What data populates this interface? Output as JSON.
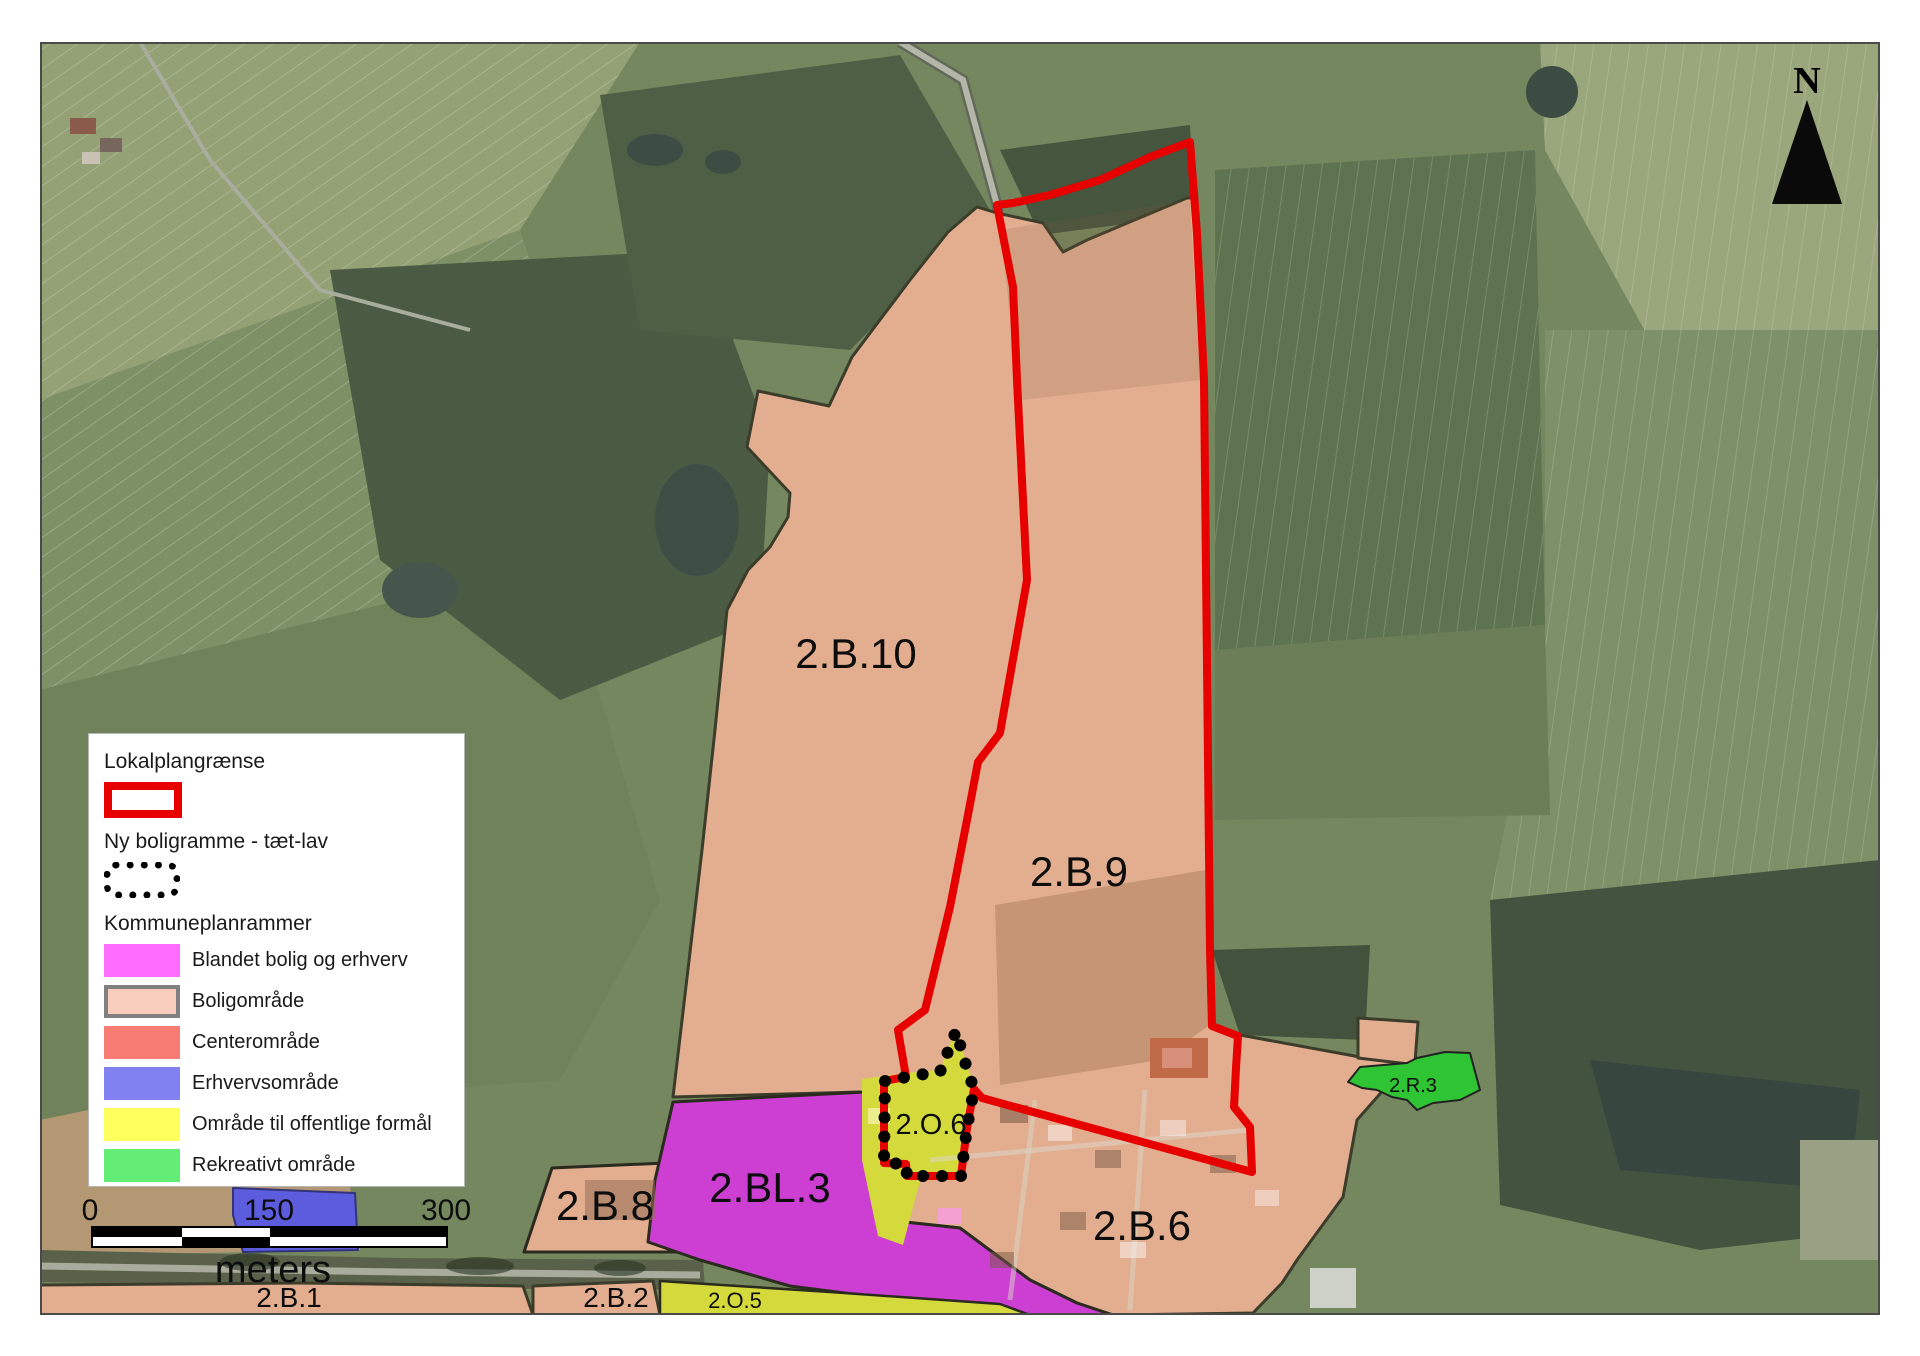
{
  "map": {
    "zone_labels": {
      "b10": "2.B.10",
      "b9": "2.B.9",
      "b6": "2.B.6",
      "b8": "2.B.8",
      "bl3": "2.BL.3",
      "b1": "2.B.1",
      "b2": "2.B.2",
      "o5": "2.O.5",
      "o6": "2.O.6",
      "r3": "2.R.3"
    },
    "north_label": "N"
  },
  "colors": {
    "lokalplan_red": "#e60000",
    "bolig_fill": "#e3ae90",
    "blandet_fill": "#cc3fd2",
    "center_fill": "#f97c74",
    "erhverv_fill": "#5c5cdf",
    "offentlig_fill": "#d4da3c",
    "rekreativ_fill": "#2fc433"
  },
  "legend": {
    "lokalplan_title": "Lokalplangrænse",
    "lokalplan_swatch_style": "border:8px solid #e60000;background:#ffffff",
    "boligramme_title": "Ny boligramme - tæt-lav",
    "boligramme_swatch_style": "border:7px dotted #000000;border-radius:12px;background:transparent",
    "kommuneplan_title": "Kommuneplanrammer",
    "items": [
      {
        "label": "Blandet bolig og erhverv",
        "swatch_style": "background:#ff6bff"
      },
      {
        "label": "Boligområde",
        "swatch_style": "background:#f8cdbd;border:4px solid #808080"
      },
      {
        "label": "Centerområde",
        "swatch_style": "background:#f97c74"
      },
      {
        "label": "Erhvervsområde",
        "swatch_style": "background:#8181f2"
      },
      {
        "label": "Område til offentlige formål",
        "swatch_style": "background:#ffff5e"
      },
      {
        "label": "Rekreativt område",
        "swatch_style": "background:#63ed77"
      }
    ]
  },
  "scalebar": {
    "start": "0",
    "mid": "150",
    "end": "300",
    "unit": "meters"
  }
}
